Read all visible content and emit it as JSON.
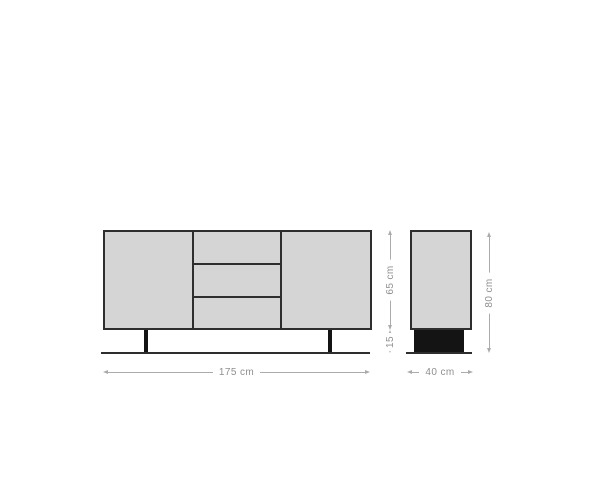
{
  "diagram": {
    "kind": "furniture-dimension-drawing",
    "subject": "sideboard",
    "dims": {
      "width": "175 cm",
      "body_height": "65 cm",
      "leg_height": "15",
      "depth": "40 cm",
      "total_height": "80 cm"
    }
  },
  "colors": {
    "body_fill": "#d5d5d5",
    "outline": "#2e2e2e",
    "leg_fill": "#141414",
    "dim_line": "#ababab",
    "dim_text": "#8f8f8f",
    "background": "#ffffff"
  }
}
